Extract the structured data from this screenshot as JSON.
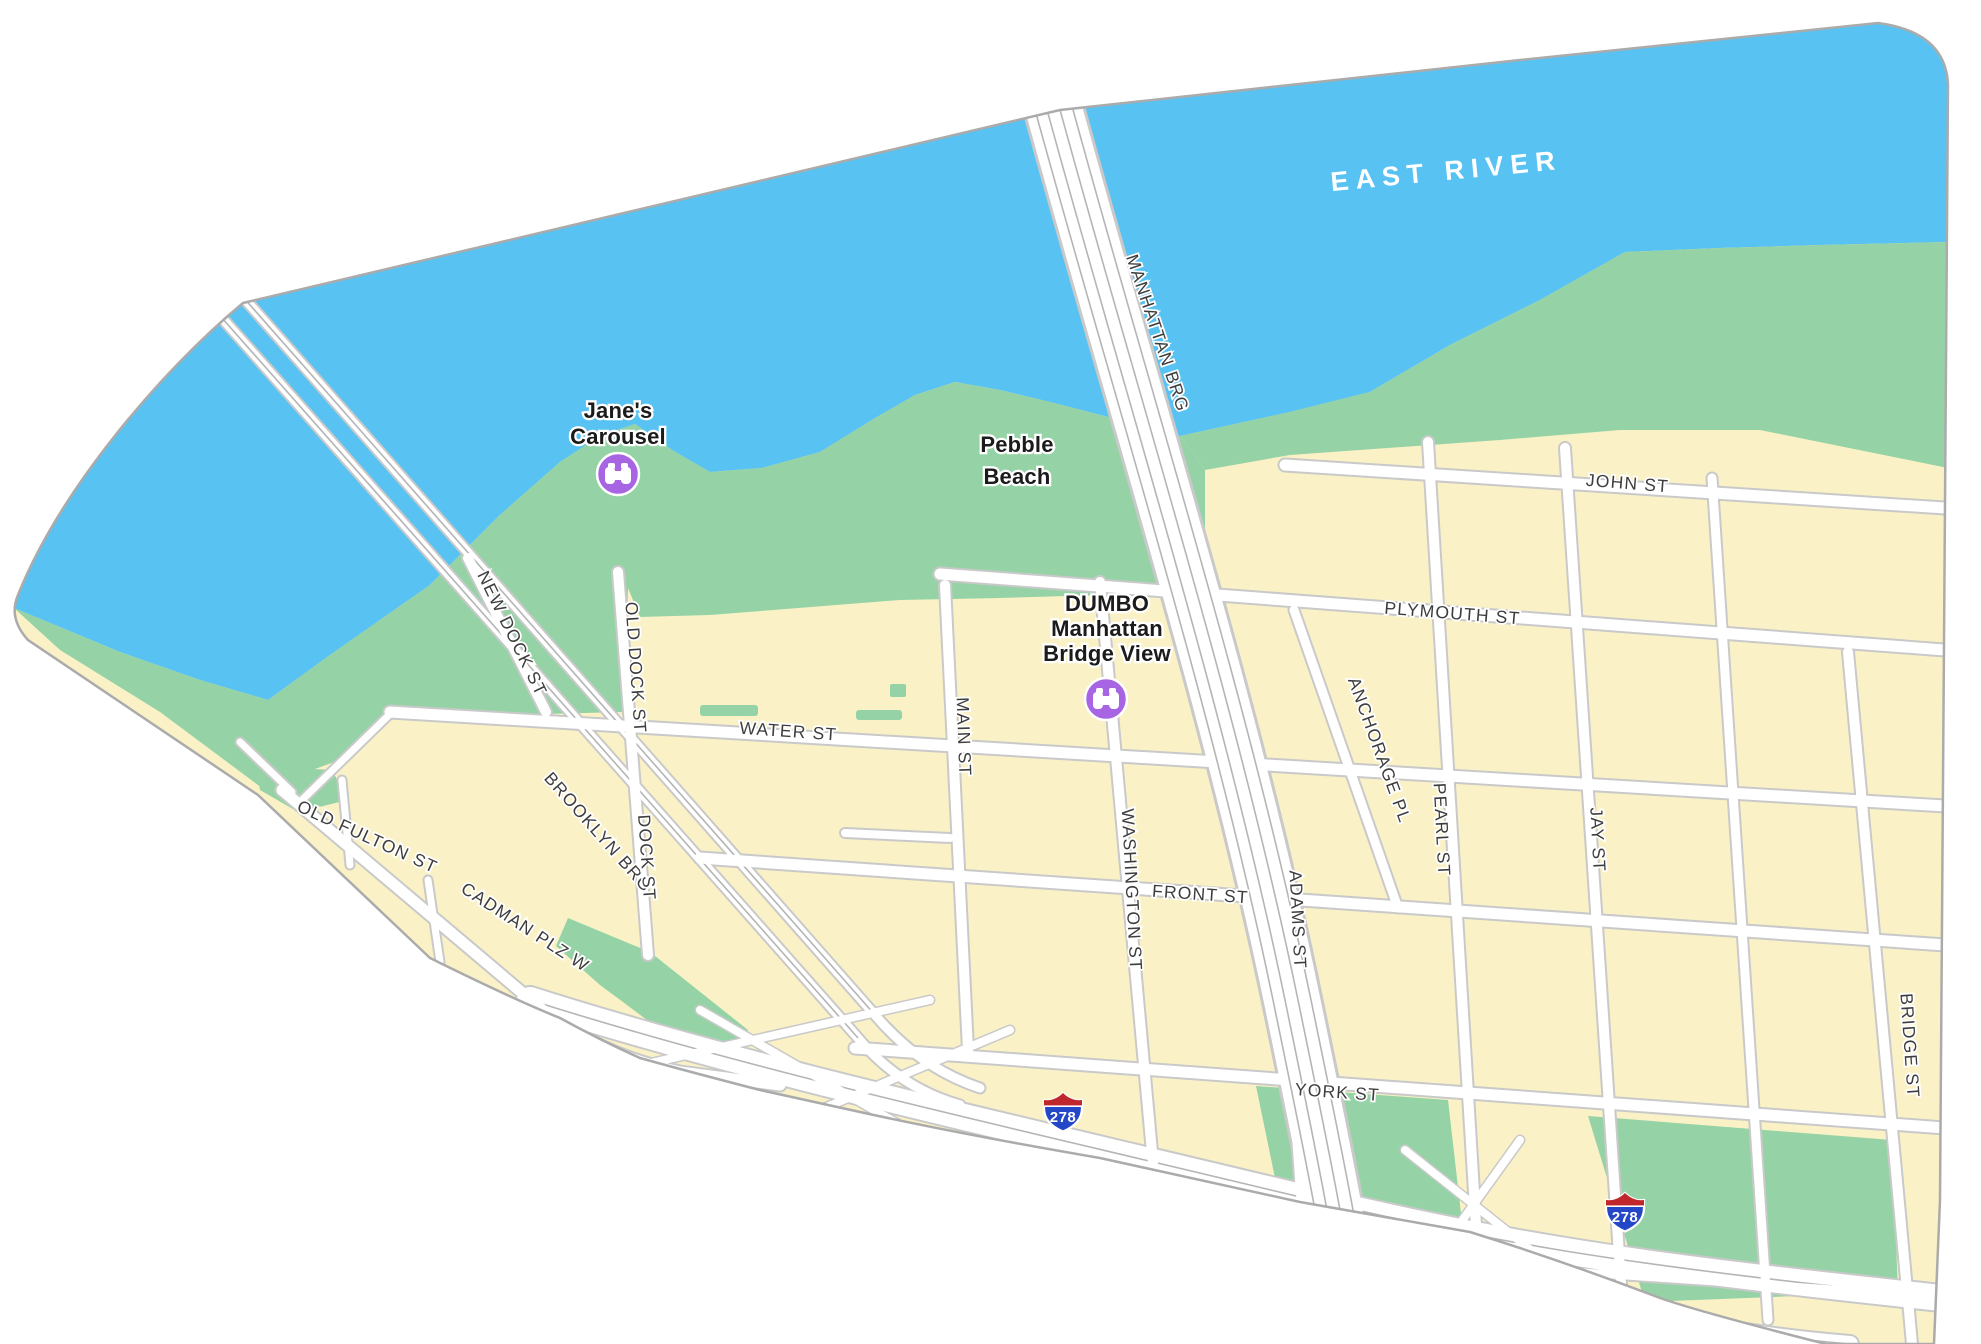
{
  "water": {
    "label": "EAST RIVER"
  },
  "bridges": [
    {
      "label": "MANHATTAN BRG"
    },
    {
      "label": "BROOKLYN BRG"
    }
  ],
  "pois": [
    {
      "id": "janes-carousel",
      "lines": [
        "Jane's",
        "Carousel"
      ],
      "icon": "binoculars-attraction-icon"
    },
    {
      "id": "pebble-beach",
      "lines": [
        "Pebble",
        "Beach"
      ]
    },
    {
      "id": "dumbo-manhattan-bridge-view",
      "lines": [
        "DUMBO",
        "Manhattan",
        "Bridge View"
      ],
      "icon": "binoculars-attraction-icon"
    }
  ],
  "streets": [
    {
      "label": "JOHN ST"
    },
    {
      "label": "PLYMOUTH ST"
    },
    {
      "label": "WATER ST"
    },
    {
      "label": "FRONT ST"
    },
    {
      "label": "YORK ST"
    },
    {
      "label": "MAIN ST"
    },
    {
      "label": "WASHINGTON ST"
    },
    {
      "label": "ADAMS ST"
    },
    {
      "label": "PEARL ST"
    },
    {
      "label": "JAY ST"
    },
    {
      "label": "BRIDGE ST"
    },
    {
      "label": "ANCHORAGE PL"
    },
    {
      "label": "OLD DOCK ST"
    },
    {
      "label": "DOCK ST"
    },
    {
      "label": "NEW DOCK ST"
    },
    {
      "label": "OLD FULTON ST"
    },
    {
      "label": "CADMAN PLZ W"
    }
  ],
  "shields": [
    {
      "number": "278"
    },
    {
      "number": "278"
    }
  ],
  "colors": {
    "water": "#58C2F2",
    "park": "#95D3A6",
    "land": "#FAF2C6",
    "road": "#FFFFFF",
    "road_casing": "#C9C9C9",
    "poi_purple": "#A865E3",
    "shield_red": "#C0272D",
    "shield_blue": "#2447C8"
  }
}
